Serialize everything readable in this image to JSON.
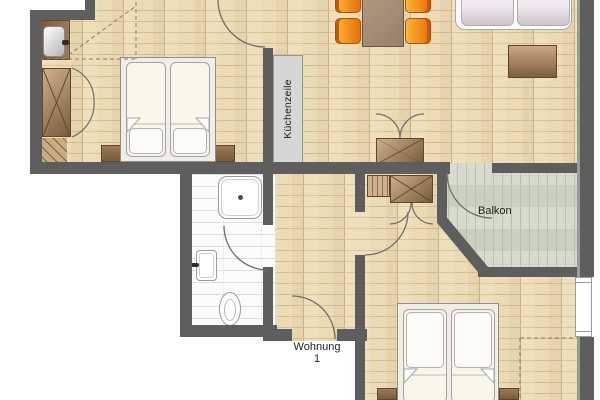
{
  "plan": {
    "type": "apartment-floor-plan",
    "labels": {
      "kitchen_unit": "Küchenzeile",
      "balcony": "Balkon",
      "apartment_name": "Wohnung",
      "apartment_number": "1"
    },
    "furniture_icons": [
      "double-bed",
      "pillow",
      "nightstand",
      "wardrobe-x",
      "bifold-doors",
      "wash-basin",
      "dining-table",
      "chair",
      "sofa",
      "sideboard",
      "kitchen-counter",
      "shower",
      "bathroom-sink",
      "toilet",
      "window",
      "door-swing-arc"
    ],
    "colors": {
      "wall": "#5e5e5e",
      "wall_edge": "#9b9b9b",
      "wood": "#ecdcb6",
      "wood_line": "#d6bf92",
      "wood_joint": "#cfb587",
      "balcony": "#d0d6c5",
      "balcony_line": "#b7c1ab",
      "tile": "#fbfbfb",
      "tile_line": "#dedede",
      "brown_dark": "#7a5a3c",
      "brown_mid": "#9c7a55",
      "brown_light": "#cdb189",
      "brown_border": "#5f4630",
      "orange_light": "#fbb733",
      "orange_dark": "#e86e0a",
      "orange_border": "#a8560b",
      "orange_back": "#c25a08",
      "counter": "#d6d6d6",
      "counter_border": "#969696",
      "furn_white": "#fcfcfc",
      "furn_border": "#9a9a9a",
      "cushion_light": "#efeaee",
      "cushion_dark": "#ccc4cb",
      "mattress": "#f8f5ea",
      "mattress_border": "#a3a3a3",
      "frame": "#efeee8",
      "arc": "#6d6d6d",
      "dash": "#8a7a5e",
      "text": "#1d1d1d"
    }
  }
}
